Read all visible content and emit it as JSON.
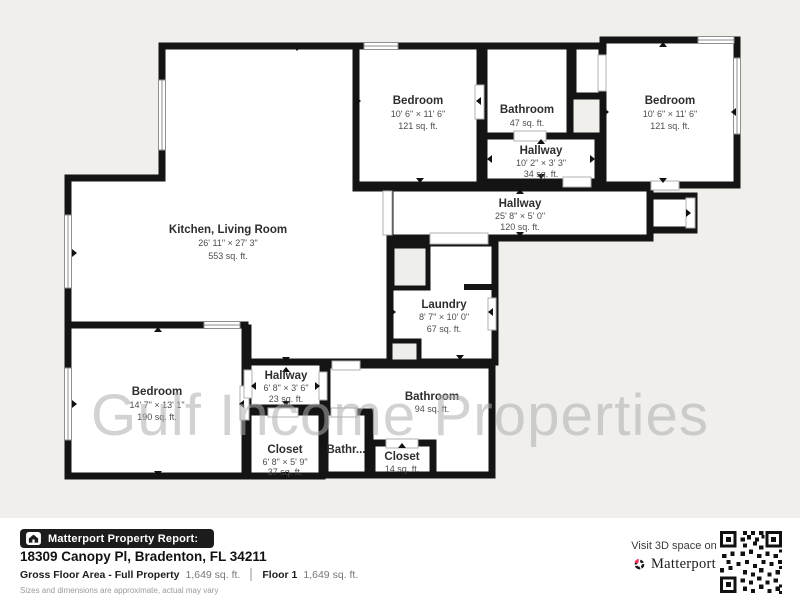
{
  "watermark": {
    "text": "Gulf Income Properties"
  },
  "colors": {
    "background": "#f0efec",
    "wall": "#141414",
    "room_fill": "#ffffff",
    "footer_background": "#ffffff",
    "badge_background": "#1c1c1c",
    "brand_accent_red": "#ee3a5f",
    "watermark_gray": "#aeaeae"
  },
  "icons": {
    "badge": "house-icon",
    "brand": "matterport-pinwheel-icon",
    "qr": "qr-code"
  },
  "rooms": [
    {
      "id": "kitchen-living",
      "name": "Kitchen, Living Room",
      "dims": "26' 11\" × 27' 3\"",
      "area": "553 sq. ft."
    },
    {
      "id": "bedroom-top-left",
      "name": "Bedroom",
      "dims": "10' 6\" × 11' 6\"",
      "area": "121 sq. ft."
    },
    {
      "id": "bathroom-top",
      "name": "Bathroom",
      "dims": "",
      "area": "47 sq. ft."
    },
    {
      "id": "bedroom-top-right",
      "name": "Bedroom",
      "dims": "10' 6\" × 11' 6\"",
      "area": "121 sq. ft."
    },
    {
      "id": "hallway-upper",
      "name": "Hallway",
      "dims": "10' 2\" × 3' 3\"",
      "area": "34 sq. ft."
    },
    {
      "id": "hallway-long",
      "name": "Hallway",
      "dims": "25' 8\" × 5' 0\"",
      "area": "120 sq. ft."
    },
    {
      "id": "laundry",
      "name": "Laundry",
      "dims": "8' 7\" × 10' 0\"",
      "area": "67 sq. ft."
    },
    {
      "id": "bedroom-bottom-left",
      "name": "Bedroom",
      "dims": "14' 7\" × 13' 1\"",
      "area": "190 sq. ft."
    },
    {
      "id": "hallway-bottom",
      "name": "Hallway",
      "dims": "6' 8\" × 3' 6\"",
      "area": "23 sq. ft."
    },
    {
      "id": "bathroom-main",
      "name": "Bathroom",
      "dims": "",
      "area": "94 sq. ft."
    },
    {
      "id": "closet-bottom",
      "name": "Closet",
      "dims": "6' 8\" × 5' 9\"",
      "area": "37 sq. ft."
    },
    {
      "id": "bathroom-small",
      "name": "Bathr...",
      "dims": "",
      "area": ""
    },
    {
      "id": "closet-small",
      "name": "Closet",
      "dims": "",
      "area": "14 sq. ft."
    }
  ],
  "footer": {
    "report_badge": "Matterport Property Report:",
    "address": "18309 Canopy Pl, Bradenton, FL 34211",
    "gross_label": "Gross Floor Area - Full Property",
    "gross_value": "1,649 sq. ft.",
    "floor_label": "Floor 1",
    "floor_value": "1,649 sq. ft.",
    "disclaimer": "Sizes and dimensions are approximate, actual may vary",
    "visit_text": "Visit 3D space on",
    "brand": "Matterport"
  }
}
